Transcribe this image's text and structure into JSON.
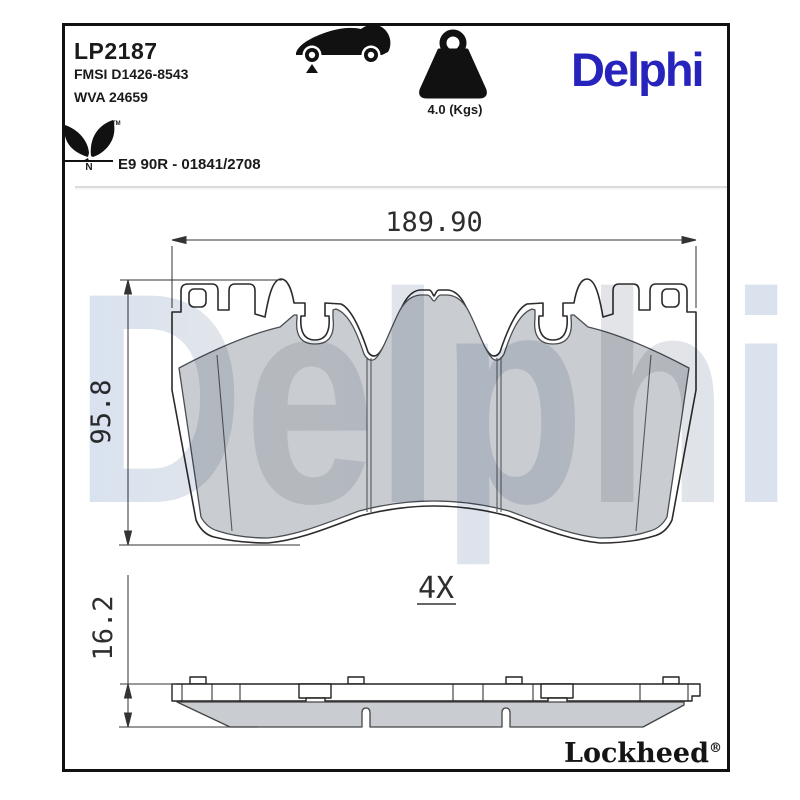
{
  "header": {
    "part_number": "LP2187",
    "fmsi": "FMSI D1426-8543",
    "wva": "WVA 24659",
    "weight": "4.0 (Kgs)",
    "brand_logo": "Delphi",
    "homologation": "E9 90R - 01841/2708",
    "leaf_trademark": "TM",
    "leaf_letter": "N"
  },
  "dimensions": {
    "width": "189.90",
    "height": "95.8",
    "thickness": "16.2",
    "quantity": "4X"
  },
  "watermark": "Delphi",
  "footer": {
    "brand": "Lockheed",
    "registered": "®"
  },
  "colors": {
    "brand_blue": "#2724bd",
    "friction_gray": "#c9cdd1",
    "line": "#2b2b2b"
  }
}
